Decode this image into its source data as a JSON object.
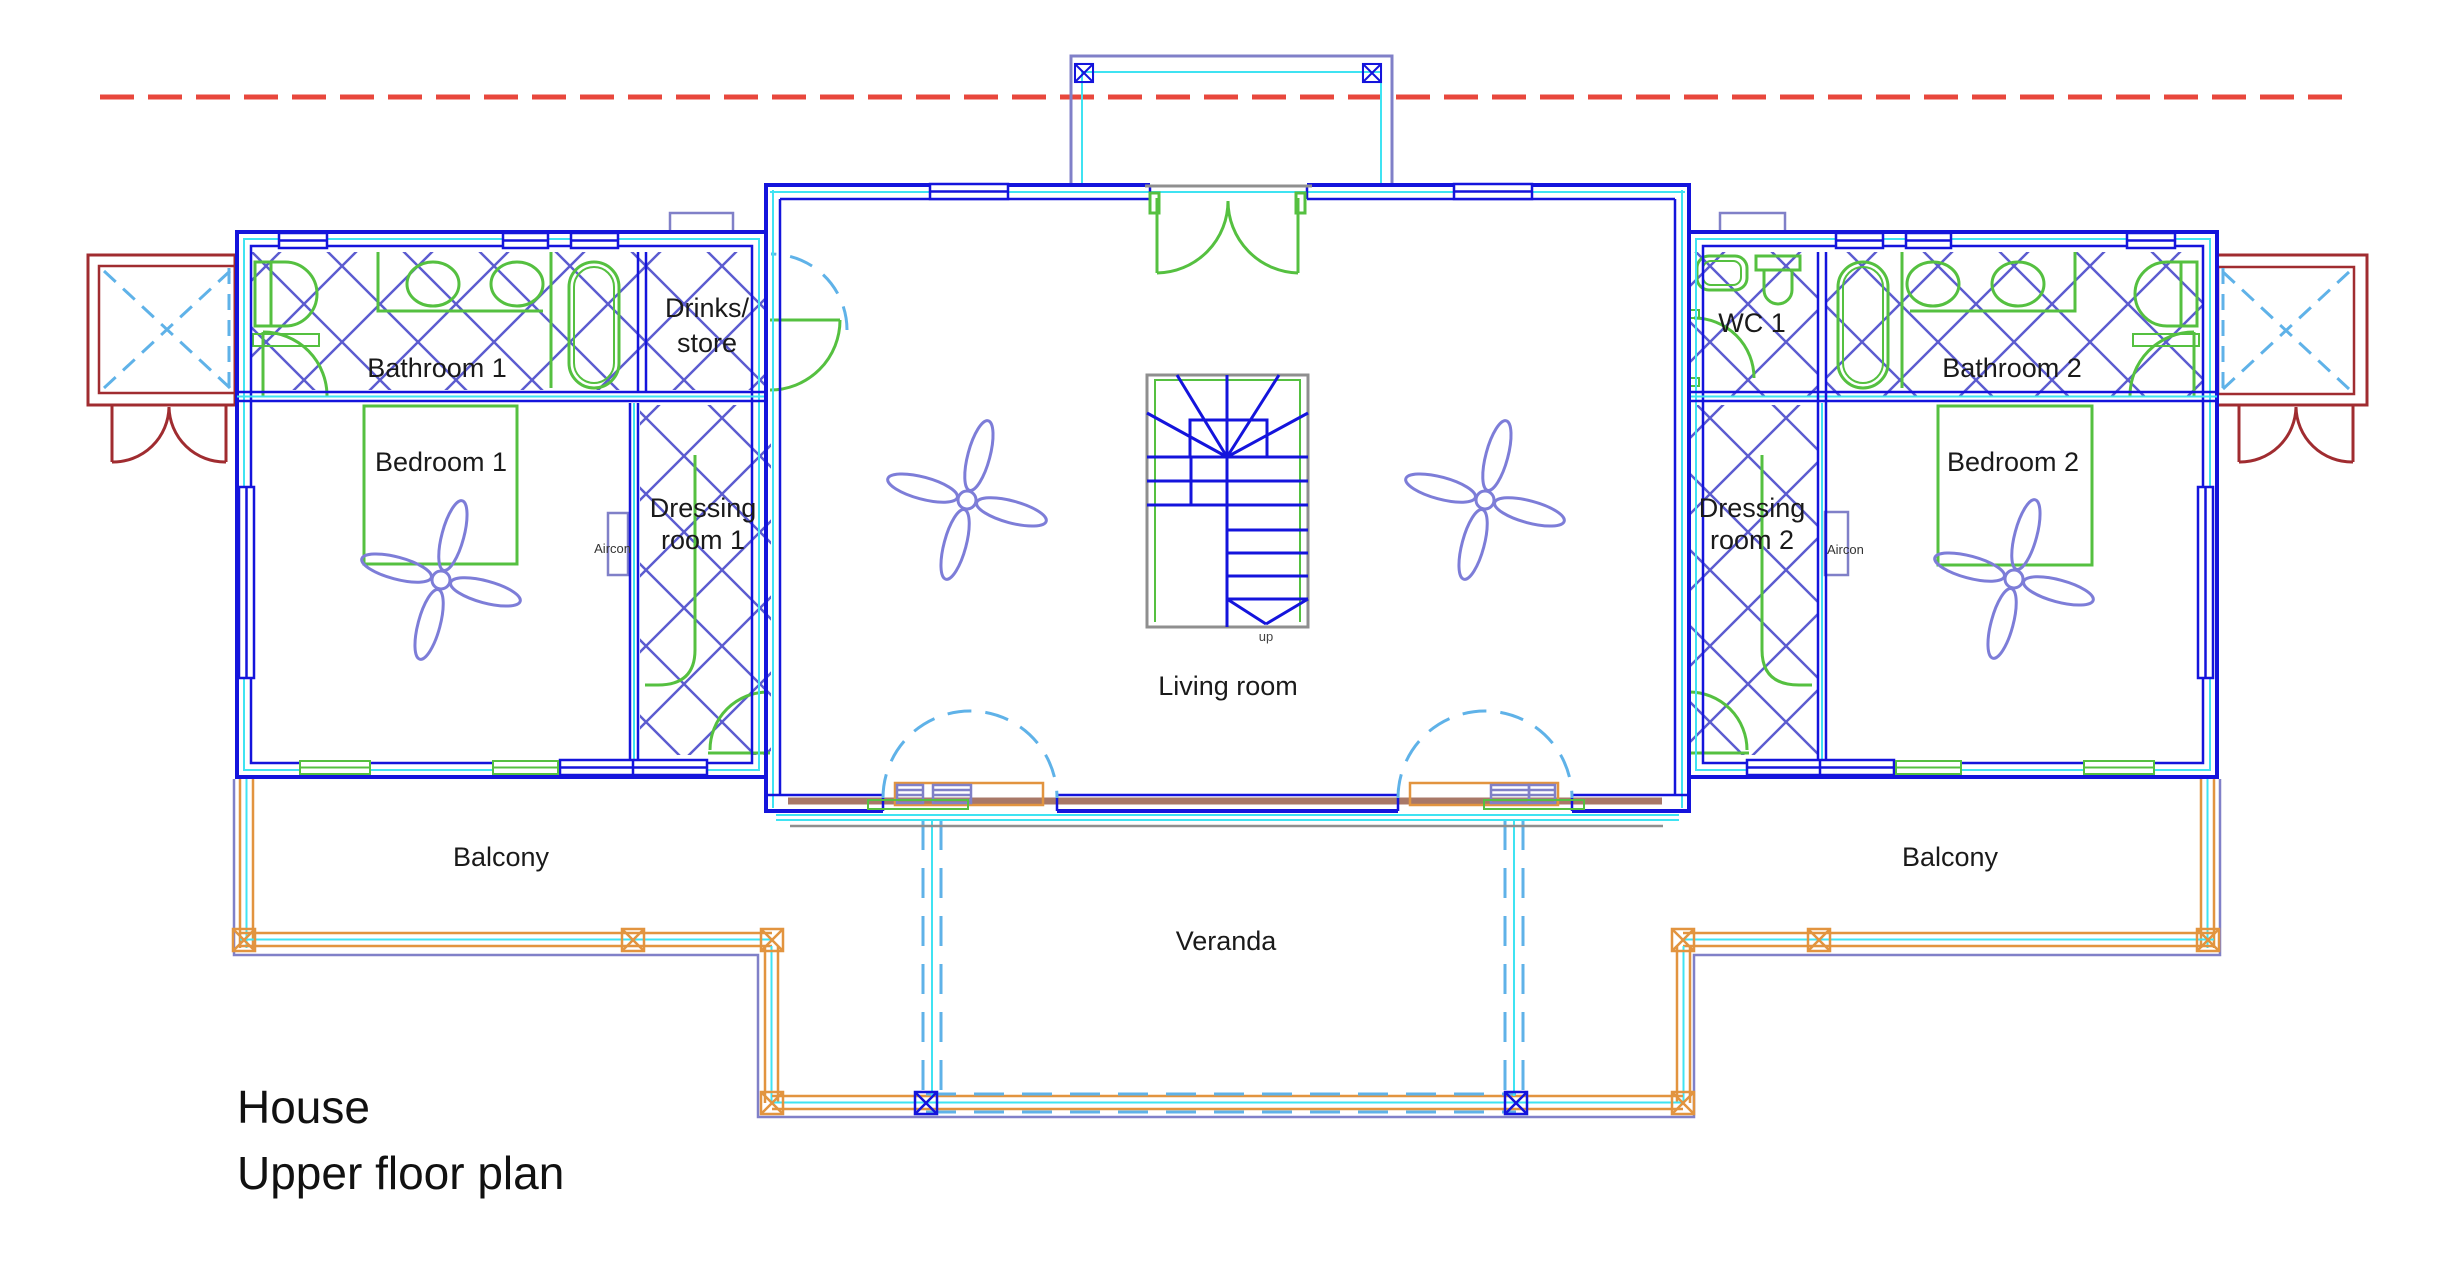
{
  "title": {
    "line1": "House",
    "line2": "Upper floor plan"
  },
  "rooms": {
    "bathroom1": "Bathroom 1",
    "drinks_store_line1": "Drinks/",
    "drinks_store_line2": "store",
    "wc1": "WC 1",
    "bathroom2": "Bathroom 2",
    "bedroom1": "Bedroom 1",
    "bedroom2": "Bedroom 2",
    "dressing1_line1": "Dressing",
    "dressing1_line2": "room 1",
    "dressing2_line1": "Dressing",
    "dressing2_line2": "room 2",
    "living_room": "Living room",
    "balcony_left": "Balcony",
    "balcony_right": "Balcony",
    "veranda": "Veranda"
  },
  "annotations": {
    "aircon_left": "Aircon",
    "aircon_right": "Aircon",
    "stairs_direction": "up"
  },
  "colors": {
    "wall": "#1414dc",
    "accent_cyan": "#3fe3f2",
    "fixture_green": "#55c040",
    "hatch_blue": "#5c5cd0",
    "periwinkle": "#8080c8",
    "fan_blue": "#7d7dd8",
    "railing_orange": "#e2943f",
    "porch_red": "#a02c30",
    "datum_red": "#e8473c",
    "swing_blue": "#5fb2e8",
    "stair_gray": "#8f8f8f",
    "track_brown": "#a87868",
    "label_text": "#1a1a1a"
  }
}
